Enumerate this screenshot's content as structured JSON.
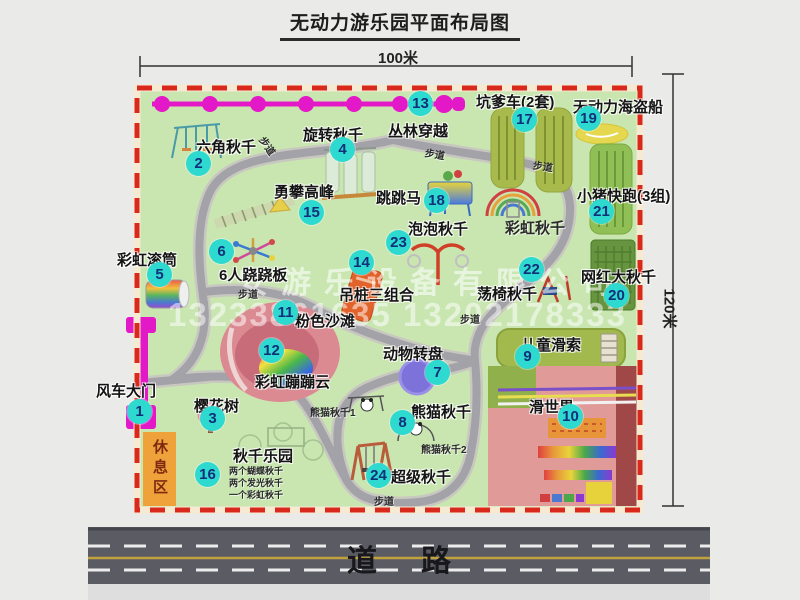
{
  "title": "无动力游乐园平面布局图",
  "dimensions": {
    "width": "100米",
    "height": "120米"
  },
  "road_label": "道路",
  "rest_area_label": "休息区",
  "watermark": {
    "line1": "安游乐设备有限公司",
    "line2": "13233861635 13202178333"
  },
  "colors": {
    "badge": "#2ed9cf",
    "badge_text": "#11307a",
    "map_green": "#c9e6b1",
    "border_red": "#d9291c",
    "path_gray": "#a2a2a8",
    "road_gray": "#5b5b63",
    "magenta": "#e318c6",
    "rest_orange": "#f0a23a"
  },
  "attractions": [
    {
      "num": 1,
      "label": "风车大门",
      "label_pos": [
        96,
        380
      ],
      "badge": [
        140,
        412
      ]
    },
    {
      "num": 2,
      "label": "六角秋千",
      "label_pos": [
        196,
        136
      ],
      "badge": [
        199,
        164
      ]
    },
    {
      "num": 3,
      "label": "樱花树",
      "label_pos": [
        194,
        395
      ],
      "badge": [
        213,
        419
      ]
    },
    {
      "num": 4,
      "label": "旋转秋千",
      "label_pos": [
        303,
        124
      ],
      "badge": [
        343,
        150
      ]
    },
    {
      "num": 5,
      "label": "彩虹滚筒",
      "label_pos": [
        117,
        249
      ],
      "badge": [
        160,
        275
      ]
    },
    {
      "num": 6,
      "label": "6人跷跷板",
      "label_pos": [
        219,
        264
      ],
      "badge": [
        222,
        252
      ]
    },
    {
      "num": 7,
      "label": "动物转盘",
      "label_pos": [
        383,
        343
      ],
      "badge": [
        438,
        373
      ]
    },
    {
      "num": 8,
      "label": "熊猫秋千",
      "label_pos": [
        411,
        401
      ],
      "badge": [
        403,
        423
      ]
    },
    {
      "num": 9,
      "label": "儿童滑索",
      "label_pos": [
        521,
        334
      ],
      "badge": [
        528,
        357
      ]
    },
    {
      "num": 10,
      "label": "滑世界",
      "label_pos": [
        529,
        396
      ],
      "badge": [
        571,
        417
      ]
    },
    {
      "num": 11,
      "label": "粉色沙滩",
      "label_pos": [
        295,
        310
      ],
      "badge": [
        286,
        313
      ]
    },
    {
      "num": 12,
      "label": "彩虹蹦蹦云",
      "label_pos": [
        255,
        371
      ],
      "badge": [
        272,
        351
      ]
    },
    {
      "num": 13,
      "label": "丛林穿越",
      "label_pos": [
        388,
        120
      ],
      "badge": [
        421,
        104
      ]
    },
    {
      "num": 14,
      "label": "吊桩三组合",
      "label_pos": [
        339,
        284
      ],
      "badge": [
        362,
        263
      ]
    },
    {
      "num": 15,
      "label": "勇攀高峰",
      "label_pos": [
        274,
        181
      ],
      "badge": [
        312,
        213
      ]
    },
    {
      "num": 16,
      "label": "秋千乐园",
      "label_pos": [
        233,
        445
      ],
      "badge": [
        208,
        475
      ]
    },
    {
      "num": 17,
      "label": "坑爹车(2套)",
      "label_pos": [
        476,
        91
      ],
      "badge": [
        525,
        120
      ]
    },
    {
      "num": 18,
      "label": "跳跳马",
      "label_pos": [
        376,
        187
      ],
      "badge": [
        437,
        201
      ]
    },
    {
      "num": 19,
      "label": "无动力海盗船",
      "label_pos": [
        573,
        96
      ],
      "badge": [
        589,
        119
      ]
    },
    {
      "num": 20,
      "label": "网红大秋千",
      "label_pos": [
        581,
        266
      ],
      "badge": [
        617,
        296
      ]
    },
    {
      "num": 21,
      "label": "小猪快跑(3组)",
      "label_pos": [
        577,
        185
      ],
      "badge": [
        602,
        212
      ]
    },
    {
      "num": 22,
      "label": "荡椅秋千",
      "label_pos": [
        477,
        283
      ],
      "badge": [
        532,
        270
      ]
    },
    {
      "num": 23,
      "label": "泡泡秋千",
      "label_pos": [
        408,
        218
      ],
      "badge": [
        399,
        243
      ]
    },
    {
      "num": 24,
      "label": "超级秋千",
      "label_pos": [
        391,
        466
      ],
      "badge": [
        379,
        476
      ]
    }
  ],
  "extra_labels": [
    {
      "text": "彩虹秋千",
      "x": 505,
      "y": 217,
      "size": 15,
      "name": "rainbow-swing-label"
    },
    {
      "text": "熊猫秋千1",
      "x": 310,
      "y": 404,
      "size": 10,
      "name": "panda-swing-1-label"
    },
    {
      "text": "熊猫秋千2",
      "x": 421,
      "y": 441,
      "size": 10,
      "name": "panda-swing-2-label"
    },
    {
      "text": "两个蝴蝶秋千",
      "x": 229,
      "y": 464,
      "size": 9,
      "name": "swing-park-note-1"
    },
    {
      "text": "两个发光秋千",
      "x": 229,
      "y": 476,
      "size": 9,
      "name": "swing-park-note-2"
    },
    {
      "text": "一个彩虹秋千",
      "x": 229,
      "y": 488,
      "size": 9,
      "name": "swing-park-note-3"
    },
    {
      "text": "步道",
      "x": 258,
      "y": 138,
      "size": 10,
      "rot": 55,
      "name": "footpath-label"
    },
    {
      "text": "步道",
      "x": 425,
      "y": 146,
      "size": 10,
      "rot": 10,
      "name": "footpath-label"
    },
    {
      "text": "步道",
      "x": 533,
      "y": 158,
      "size": 10,
      "rot": 8,
      "name": "footpath-label"
    },
    {
      "text": "步道",
      "x": 238,
      "y": 286,
      "size": 10,
      "rot": 0,
      "name": "footpath-label"
    },
    {
      "text": "步道",
      "x": 460,
      "y": 311,
      "size": 10,
      "rot": 0,
      "name": "footpath-label"
    },
    {
      "text": "步道",
      "x": 374,
      "y": 493,
      "size": 10,
      "rot": 0,
      "name": "footpath-label"
    }
  ]
}
